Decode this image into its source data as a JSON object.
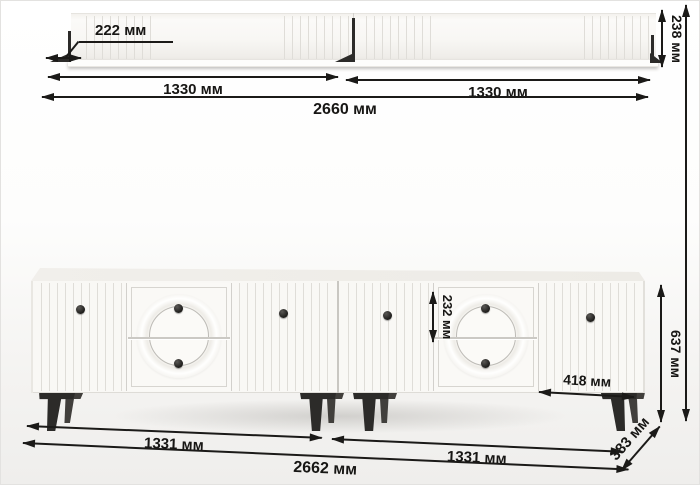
{
  "shelf": {
    "offset_label": "222 мм",
    "left_section_label": "1330 мм",
    "right_section_label": "1330 мм",
    "total_width_label": "2660 мм",
    "height_label": "238 мм"
  },
  "cabinet": {
    "top_drawer_label": "232 мм",
    "door_width_label": "418 мм",
    "height_label": "637 мм",
    "left_section_label": "1331 мм",
    "right_section_label": "1331 мм",
    "total_width_label": "2662 мм",
    "depth_label": "383 мм"
  },
  "colors": {
    "dimension_ink": "#1b1a18",
    "furniture_white": "#f9f8f5",
    "hardware_dark": "#2c2b29"
  }
}
